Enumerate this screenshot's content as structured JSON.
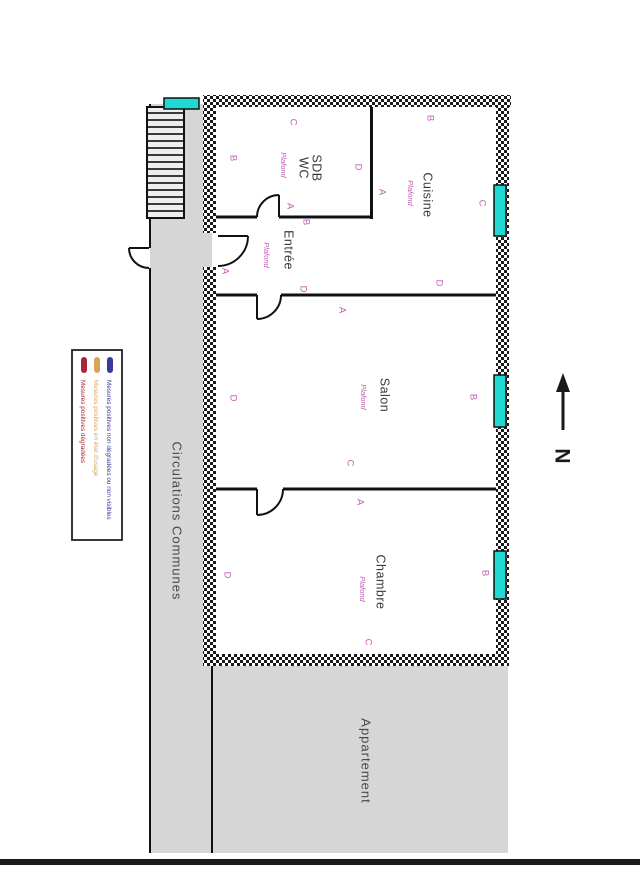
{
  "legend": {
    "items": [
      {
        "label": "Mesures positives dégradées",
        "color": "#a82638"
      },
      {
        "label": "Mesures positives en état d'usage",
        "color": "#d9a35c"
      },
      {
        "label": "Mesures positives non dégradées ou non visibles",
        "color": "#3a3a9e"
      }
    ]
  },
  "plan": {
    "rooms": {
      "sdb": {
        "line1": "SDB",
        "line2": "WC",
        "annotation": "Plafond"
      },
      "cuisine": {
        "name": "Cuisine",
        "annotation": "Plafond"
      },
      "entree": {
        "name": "Entrée",
        "annotation": "Plafond"
      },
      "salon": {
        "name": "Salon",
        "annotation": "Plafond"
      },
      "chambre": {
        "name": "Chambre",
        "annotation": "Plafond"
      }
    },
    "areas": {
      "corridor": "Circulations Communes",
      "apartment": "Appartement"
    },
    "north": "N",
    "wall_letters": [
      {
        "room": "sdb",
        "label": "C",
        "x": 293,
        "y": 122
      },
      {
        "room": "sdb",
        "label": "B",
        "x": 233,
        "y": 158
      },
      {
        "room": "sdb",
        "label": "D",
        "x": 358,
        "y": 167
      },
      {
        "room": "sdb",
        "label": "A",
        "x": 290,
        "y": 206
      },
      {
        "room": "cuisine",
        "label": "B",
        "x": 430,
        "y": 118
      },
      {
        "room": "cuisine",
        "label": "A",
        "x": 382,
        "y": 192
      },
      {
        "room": "cuisine",
        "label": "C",
        "x": 482,
        "y": 203
      },
      {
        "room": "cuisine",
        "label": "D",
        "x": 439,
        "y": 283
      },
      {
        "room": "entree",
        "label": "B",
        "x": 306,
        "y": 222
      },
      {
        "room": "entree",
        "label": "A",
        "x": 225,
        "y": 271
      },
      {
        "room": "entree",
        "label": "D",
        "x": 303,
        "y": 289
      },
      {
        "room": "salon",
        "label": "A",
        "x": 342,
        "y": 310
      },
      {
        "room": "salon",
        "label": "D",
        "x": 233,
        "y": 398
      },
      {
        "room": "salon",
        "label": "B",
        "x": 473,
        "y": 397
      },
      {
        "room": "salon",
        "label": "C",
        "x": 350,
        "y": 463
      },
      {
        "room": "chambre",
        "label": "A",
        "x": 360,
        "y": 502
      },
      {
        "room": "chambre",
        "label": "D",
        "x": 227,
        "y": 575
      },
      {
        "room": "chambre",
        "label": "B",
        "x": 485,
        "y": 573
      },
      {
        "room": "chambre",
        "label": "C",
        "x": 368,
        "y": 642
      }
    ],
    "colors": {
      "window": "#1fd9d2",
      "wall_letters": "#c45ab5",
      "area_fill": "#d6d6d6",
      "wall_hatch": "#1b1b1b"
    }
  }
}
